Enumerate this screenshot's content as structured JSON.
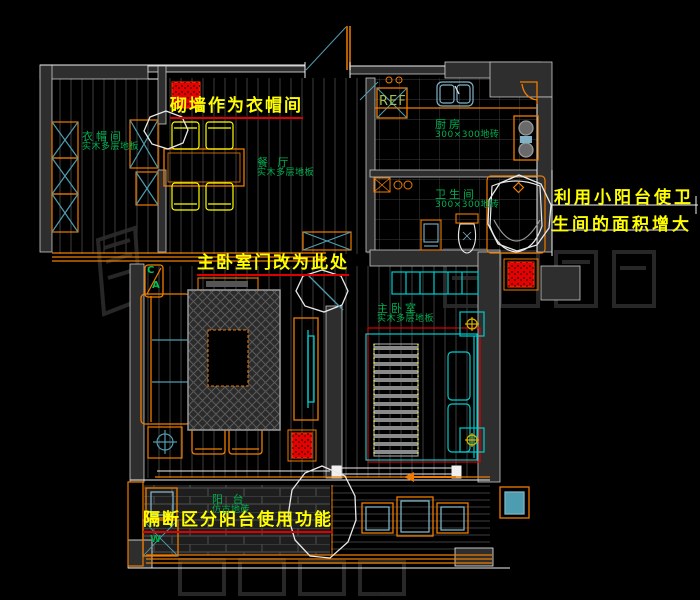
{
  "drawing": {
    "annotations": {
      "cloakroom_note": "砌墙作为衣帽间",
      "master_door_note": "主卧室门改为此处",
      "balcony_note": "隔断区分阳台使用功能",
      "bathroom_note_line1": "利用小阳台使卫",
      "bathroom_note_line2": "生间的面积增大"
    },
    "rooms": {
      "cloakroom": {
        "name": "衣帽间",
        "floor": "实木多层地板"
      },
      "dining": {
        "name": "餐 厅",
        "floor": "实木多层地板"
      },
      "kitchen": {
        "name": "厨房",
        "floor": "300×300地砖"
      },
      "bathroom": {
        "name": "卫生间",
        "floor": "300×300地砖"
      },
      "master_bedroom": {
        "name": "主卧室",
        "floor": "实木多层地板"
      },
      "balcony": {
        "name": "阳  台",
        "floor": "仿古地砖"
      }
    },
    "labels": {
      "fridge": "REF",
      "washing_machine": "W",
      "elevation_marker_top": "C",
      "elevation_marker_bottom": "A"
    },
    "colors": {
      "background": "#000000",
      "wall_fill": "#2e2e2e",
      "furniture_orange": "#ef7c00",
      "fixture_cyan": "#4e9cb0",
      "bright_cyan": "#00cccc",
      "label_green": "#00b050",
      "annotation_yellow": "#ffff00",
      "revision_red": "#ee0000",
      "line_white": "#f2f2f2"
    }
  }
}
